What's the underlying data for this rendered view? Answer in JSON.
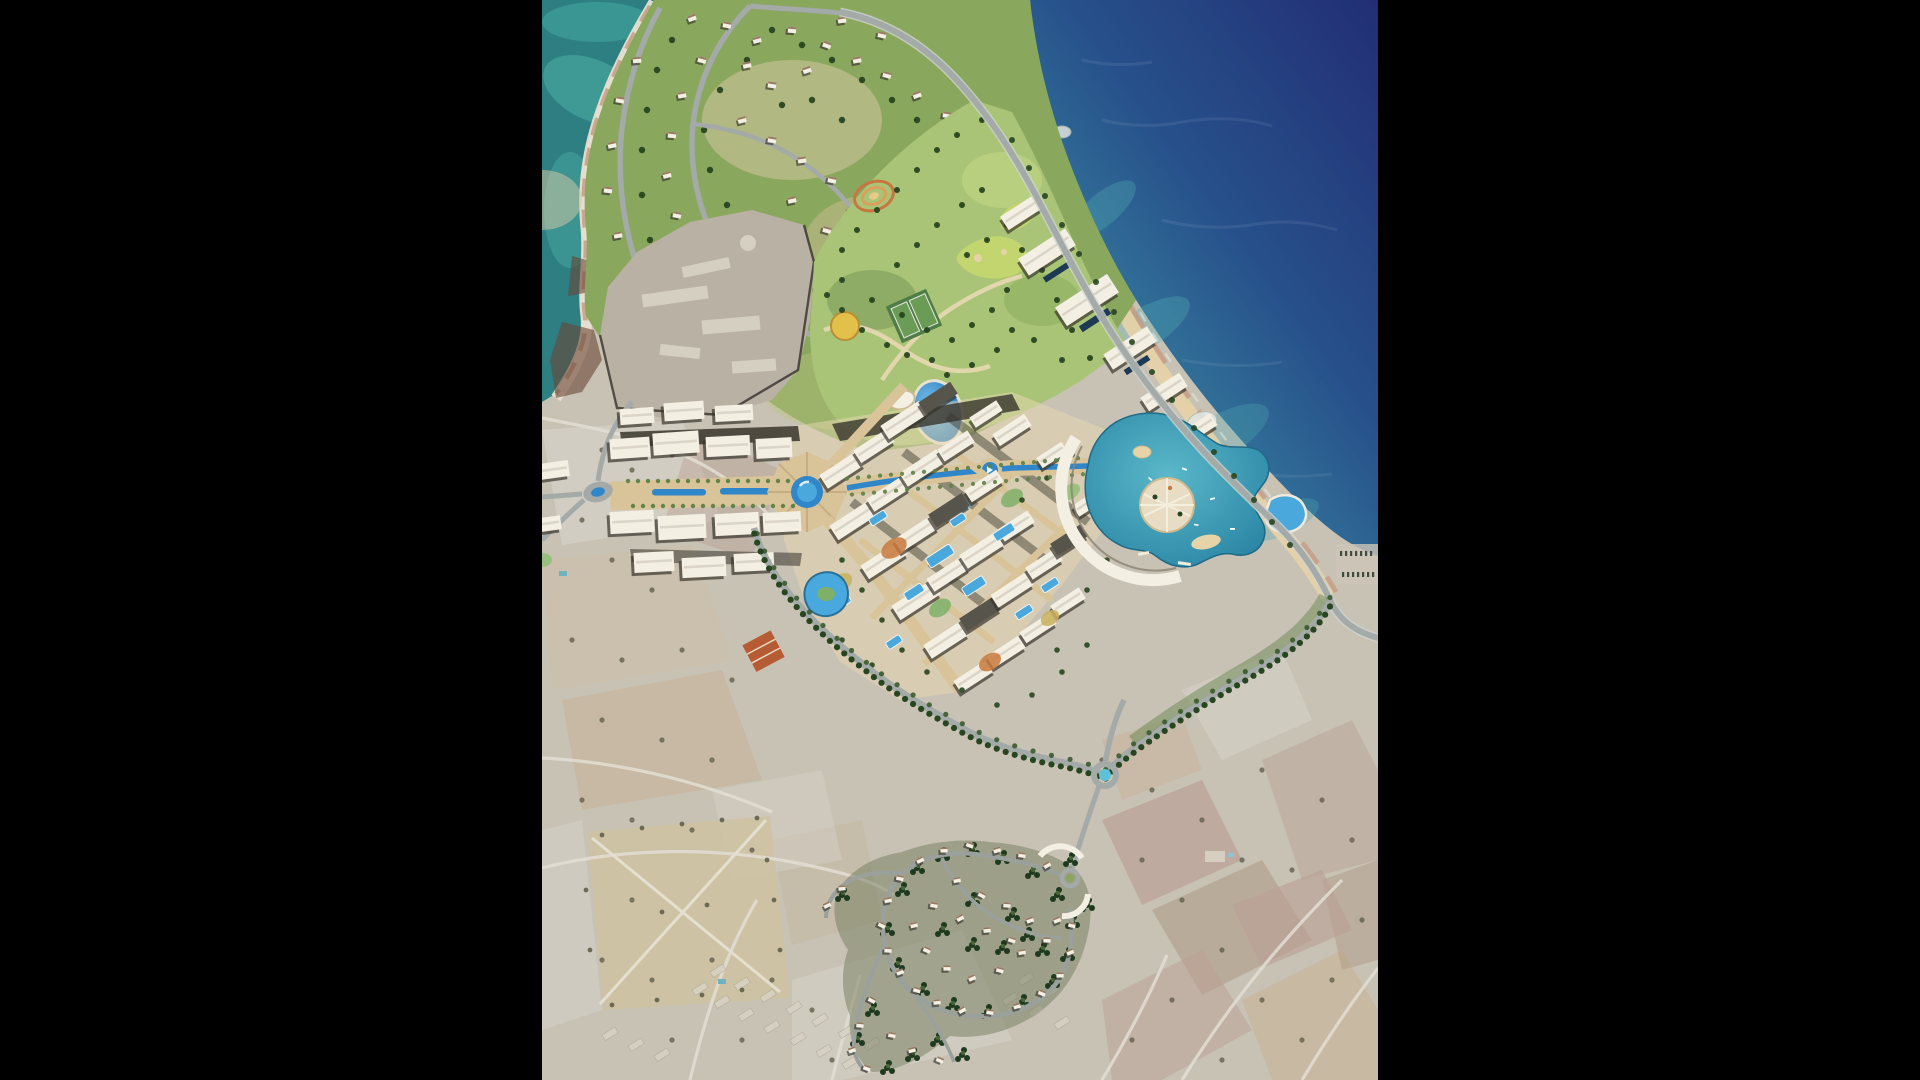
{
  "figure": {
    "kind": "aerial-masterplan-photomontage",
    "alt": "Aerial photomontage of a coastal resort town masterplan on a rocky Mediterranean headland, with a marina lagoon, central boulevard with circular fountain plazas, villa headland to the north, a retained quarry site, a tree-lined boundary avenue with roundabout, a hillside villa village to the south, and faded existing farmland around the development"
  },
  "layout": {
    "letterbox_left_px": 542,
    "letterbox_right_px": 542,
    "image_width_px": 836,
    "image_height_px": 1080
  },
  "palette": {
    "letterbox": "#000000",
    "seaDeep": "#222e74",
    "seaMid": "#27518b",
    "seaLight": "#37819f",
    "seaTeal": "#2d7f82",
    "tealLight": "#55b9ae",
    "foam": "#e8f2ef",
    "rock": "#e9e0d0",
    "rockPink": "#c4987f",
    "rockDark": "#6a4636",
    "sand": "#e6d3a8",
    "landBase": "#c8c2b5",
    "fieldPink": "#b5948a",
    "fieldTan": "#c9ad8a",
    "fieldGrey": "#d6d1c7",
    "fieldBrown": "#a58a74",
    "greenBase": "#8aa75e",
    "greenLight": "#a9c477",
    "greenDark": "#5d8045",
    "treeDark": "#27451f",
    "treeVillage": "#1e3a1e",
    "treeOlive": "#5c5a45",
    "road": "#a3aaa8",
    "roadLight": "#ced3cf",
    "paving": "#d9c499",
    "pavingLight": "#e8d8b2",
    "pavingDark": "#c3a87e",
    "building": "#f4efe3",
    "buildingShadow": "#38352c",
    "roofBrown": "#86644a",
    "waterPool": "#2f86c8",
    "waterPoolLight": "#4aa8dd",
    "lagoon": "#2f8aa8",
    "lagoonLight": "#5ab8c9",
    "navyPool": "#1d3a55",
    "quarry": "#b9b1a3",
    "existing": "#d8d2c4"
  }
}
